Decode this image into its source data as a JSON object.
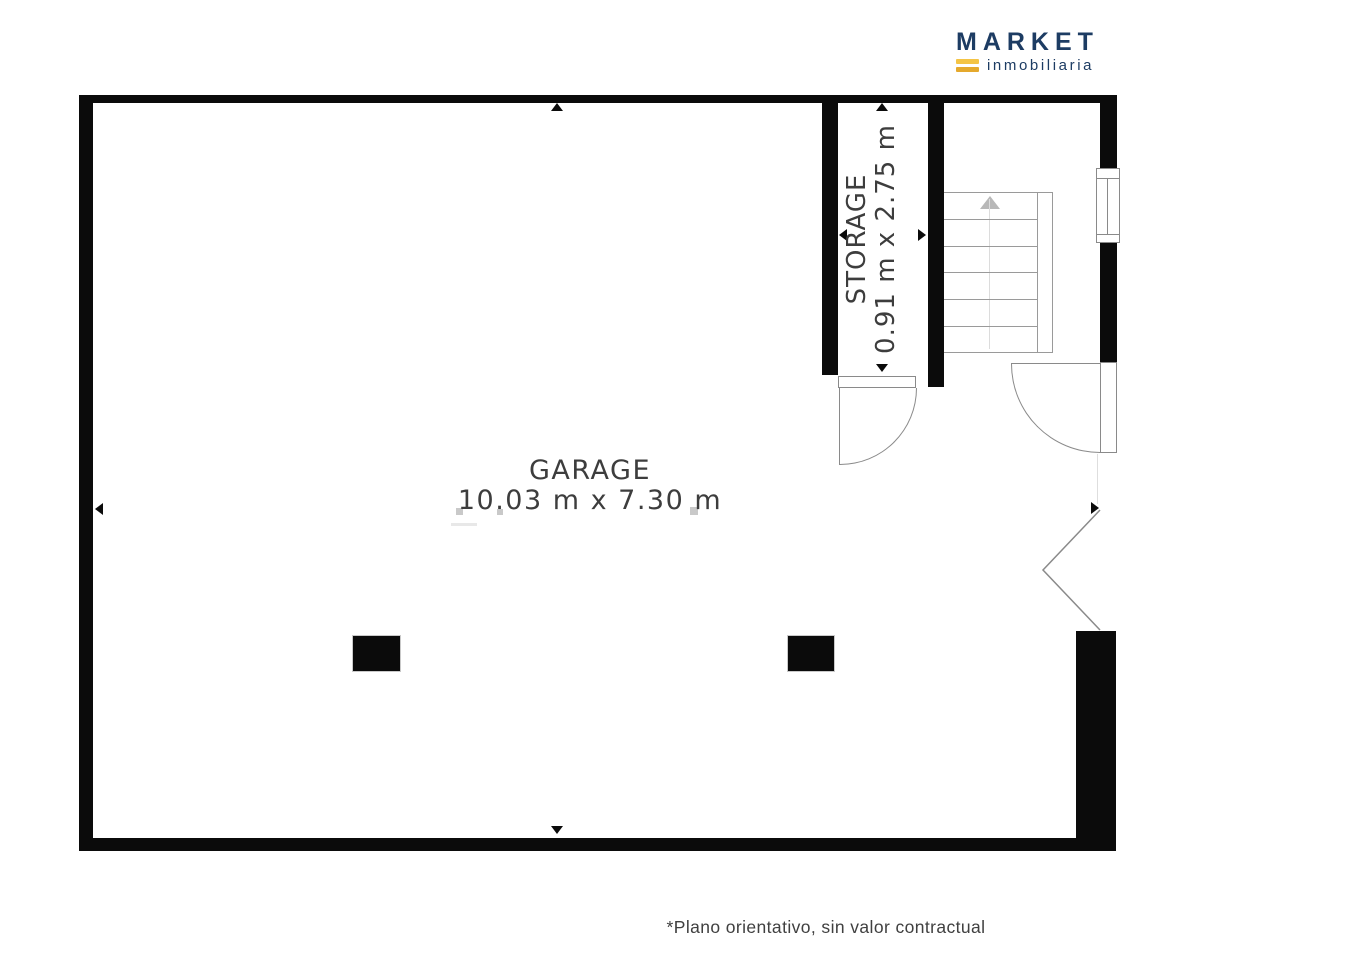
{
  "logo": {
    "brand": "MARKET",
    "subtitle": "inmobiliaria"
  },
  "plan": {
    "garage": {
      "name": "GARAGE",
      "dimensions": "10.03 m x 7.30 m"
    },
    "storage": {
      "name": "STORAGE",
      "dimensions": "0.91 m x 2.75 m"
    }
  },
  "footer": {
    "disclaimer": "*Plano orientativo, sin valor contractual"
  },
  "colors": {
    "wall": "#0b0b0b",
    "line": "#8a8a8a",
    "stairs_line": "#9a9a9a",
    "text": "#3d3d3d",
    "brand_navy": "#1d3c63",
    "brand_yellow_top": "#f4c445",
    "brand_yellow_bottom": "#e5a92d"
  }
}
